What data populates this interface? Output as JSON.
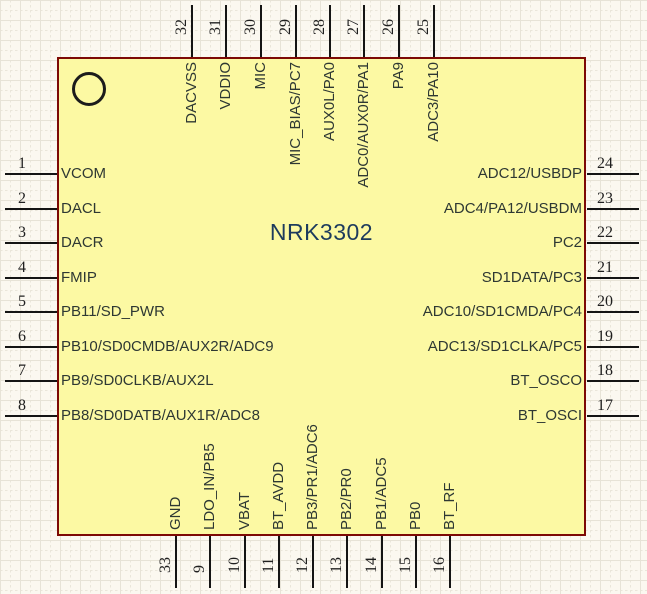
{
  "component": {
    "title": "NRK3302"
  },
  "pins": {
    "left": [
      {
        "num": "1",
        "name": "VCOM"
      },
      {
        "num": "2",
        "name": "DACL"
      },
      {
        "num": "3",
        "name": "DACR"
      },
      {
        "num": "4",
        "name": "FMIP"
      },
      {
        "num": "5",
        "name": "PB11/SD_PWR"
      },
      {
        "num": "6",
        "name": "PB10/SD0CMDB/AUX2R/ADC9"
      },
      {
        "num": "7",
        "name": "PB9/SD0CLKB/AUX2L"
      },
      {
        "num": "8",
        "name": "PB8/SD0DATB/AUX1R/ADC8"
      }
    ],
    "top": [
      {
        "num": "32",
        "name": "DACVSS"
      },
      {
        "num": "31",
        "name": "VDDIO"
      },
      {
        "num": "30",
        "name": "MIC"
      },
      {
        "num": "29",
        "name": "MIC_BIAS/PC7"
      },
      {
        "num": "28",
        "name": "AUX0L/PA0"
      },
      {
        "num": "27",
        "name": "ADC0/AUX0R/PA1"
      },
      {
        "num": "26",
        "name": "PA9"
      },
      {
        "num": "25",
        "name": "ADC3/PA10"
      }
    ],
    "right": [
      {
        "num": "24",
        "name": "ADC12/USBDP"
      },
      {
        "num": "23",
        "name": "ADC4/PA12/USBDM"
      },
      {
        "num": "22",
        "name": "PC2"
      },
      {
        "num": "21",
        "name": "SD1DATA/PC3"
      },
      {
        "num": "20",
        "name": "ADC10/SD1CMDA/PC4"
      },
      {
        "num": "19",
        "name": "ADC13/SD1CLKA/PC5"
      },
      {
        "num": "18",
        "name": "BT_OSCO"
      },
      {
        "num": "17",
        "name": "BT_OSCI"
      }
    ],
    "bottom": [
      {
        "num": "33",
        "name": "GND"
      },
      {
        "num": "9",
        "name": "LDO_IN/PB5"
      },
      {
        "num": "10",
        "name": "VBAT"
      },
      {
        "num": "11",
        "name": "BT_AVDD"
      },
      {
        "num": "12",
        "name": "PB3/PR1/ADC6"
      },
      {
        "num": "13",
        "name": "PB2/PR0"
      },
      {
        "num": "14",
        "name": "PB1/ADC5"
      },
      {
        "num": "15",
        "name": "PB0"
      },
      {
        "num": "16",
        "name": "BT_RF"
      }
    ]
  },
  "icons": {
    "marker": "circle-marker"
  },
  "colors": {
    "canvas_background": "#fbf8f0",
    "grid_line": "#e7e3d7",
    "body_fill": "#fcf9a3",
    "body_border": "#7d0a05",
    "pin_line": "#141414",
    "pin_name_text": "#2e3833",
    "pin_number_text": "#1f1f1f",
    "title_text": "#1d3b5d"
  }
}
